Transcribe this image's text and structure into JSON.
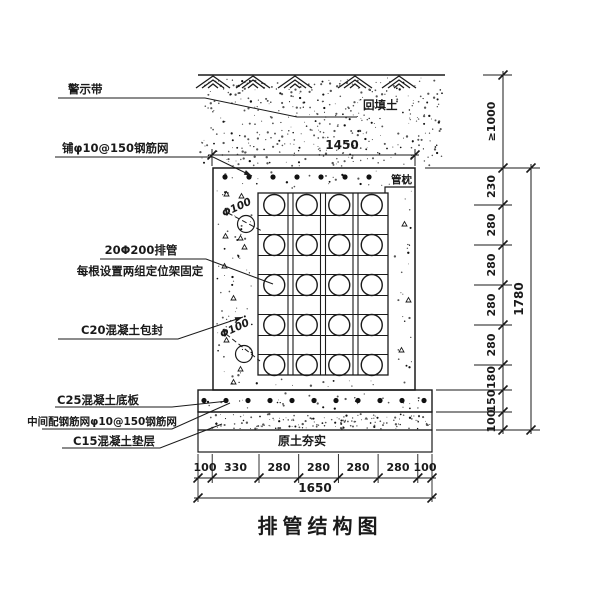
{
  "title": "排管结构图",
  "labels": {
    "warning_tape": "警示带",
    "top_mesh": "铺φ10@150钢筋网",
    "pipes_line1": "20Φ200排管",
    "pipes_line2": "每根设置两组定位架固定",
    "encasement": "C20混凝土包封",
    "base_slab": "C25混凝土底板",
    "slab_mesh": "中间配钢筋网φ10@150钢筋网",
    "cushion": "C15混凝土垫层",
    "backfill": "回填土",
    "pipe_pillow": "管枕",
    "pipe_diameter": "Φ100",
    "compacted_soil": "原土夯实"
  },
  "dimensions": {
    "top_width": "1450",
    "bottom_segments": [
      "100",
      "330",
      "280",
      "280",
      "280",
      "280",
      "100"
    ],
    "bottom_total": "1650",
    "cover_depth": "≥1000",
    "right_segments": [
      "230",
      "280",
      "280",
      "280",
      "280",
      "180",
      "150",
      "100"
    ],
    "right_total": "1780"
  },
  "colors": {
    "line": "#1a1a1a",
    "background": "#ffffff"
  }
}
